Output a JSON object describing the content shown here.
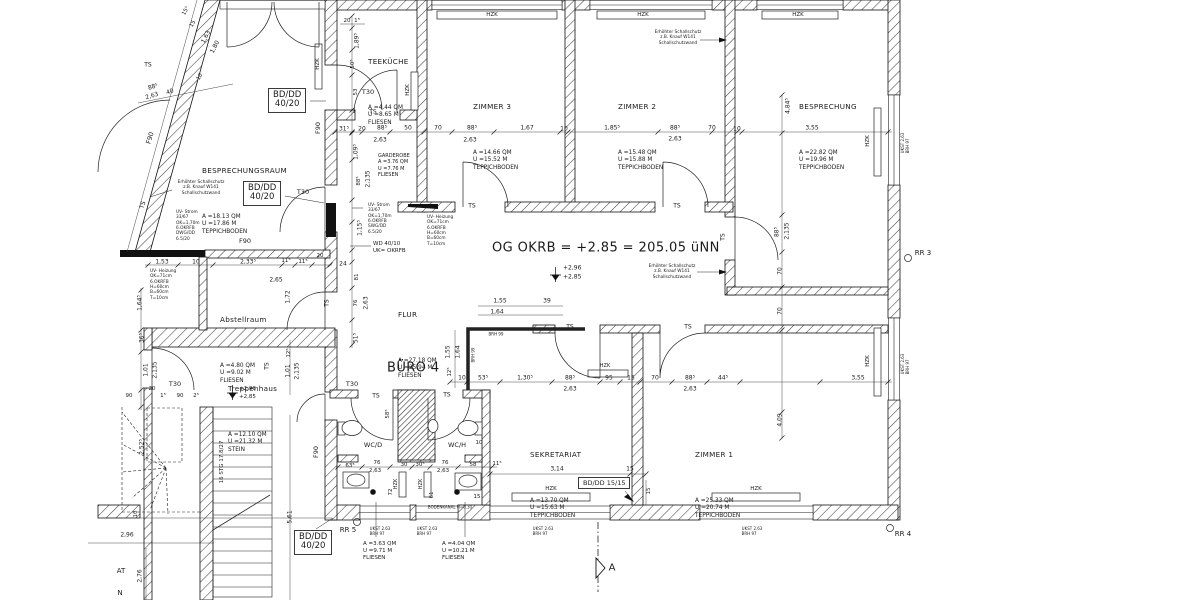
{
  "drawing": {
    "main_note": "OG OKRB = +2.85 = 205.05 üNN",
    "buero_label": "BÜRO 4"
  },
  "rooms": [
    {
      "name": "TEEKÜCHE",
      "attrs": "A =4.44 QM\nU =8.65 M\nFLIESEN",
      "x": 368,
      "y": 19
    },
    {
      "name": "ZIMMER 3",
      "attrs": "A =14.66 QM\nU =15.52 M\nTEPPICHBODEN",
      "x": 473,
      "y": 64
    },
    {
      "name": "ZIMMER 2",
      "attrs": "A =15.48 QM\nU =15.88 M\nTEPPICHBODEN",
      "x": 618,
      "y": 64
    },
    {
      "name": "BESPRECHUNG",
      "attrs": "A =22.82 QM\nU =19.96 M\nTEPPICHBODEN",
      "x": 799,
      "y": 64
    },
    {
      "name": "BESPRECHUNGSRAUM",
      "attrs": "A =18.13 QM\nU =17.86 M\nTEPPICHBODEN",
      "x": 202,
      "y": 128
    },
    {
      "name": "Abstellraum",
      "attrs": "A =4.80 QM\nU =9.02 M\nFLIESEN",
      "x": 220,
      "y": 277
    },
    {
      "name": "FLUR",
      "attrs": "A =27.18 QM\nU =25.94 M\nFLIESEN",
      "x": 398,
      "y": 272
    },
    {
      "name": "Treppenhaus",
      "attrs": "A =12.10 QM\nU =21.32 M\nSTEIN",
      "x": 228,
      "y": 346
    },
    {
      "name": "SEKRETARIAT",
      "attrs": "A =13.70 QM\nU =15.63 M\nTEPPICHBODEN",
      "x": 530,
      "y": 412
    },
    {
      "name": "ZIMMER 1",
      "attrs": "A =25.33 QM\nU =20.74 M\nTEPPICHBODEN",
      "x": 695,
      "y": 412
    }
  ],
  "big_texts": [
    {
      "t": "OG OKRB = +2.85 = 205.05 üNN",
      "x": 492,
      "y": 248,
      "fs": 13,
      "a": "l"
    },
    {
      "t": "BÜRO 4",
      "x": 387,
      "y": 368,
      "fs": 13,
      "a": "l"
    }
  ],
  "boxes": [
    {
      "t": "BD/DD\n40/20",
      "x": 268,
      "y": 88
    },
    {
      "t": "BD/DD\n40/20",
      "x": 243,
      "y": 181
    },
    {
      "t": "BD/DD\n40/20",
      "x": 294,
      "y": 530
    },
    {
      "t": "BD/DD 15/15",
      "x": 578,
      "y": 477,
      "fs": 6.5
    }
  ],
  "labels": [
    {
      "t": "T30",
      "x": 368,
      "y": 92,
      "fs": 6.5
    },
    {
      "t": "T30",
      "x": 303,
      "y": 192,
      "fs": 6.5
    },
    {
      "t": "T30",
      "x": 175,
      "y": 384,
      "fs": 6.5
    },
    {
      "t": "T30",
      "x": 352,
      "y": 384,
      "fs": 6.5
    },
    {
      "t": "TS",
      "x": 148,
      "y": 65,
      "fs": 6
    },
    {
      "t": "TS",
      "x": 373,
      "y": 112,
      "fs": 6
    },
    {
      "t": "TS",
      "x": 472,
      "y": 206,
      "fs": 6
    },
    {
      "t": "TS",
      "x": 677,
      "y": 206,
      "fs": 6
    },
    {
      "t": "TS",
      "x": 723,
      "y": 237,
      "r": -90,
      "fs": 6
    },
    {
      "t": "TS",
      "x": 570,
      "y": 327,
      "fs": 6
    },
    {
      "t": "TS",
      "x": 688,
      "y": 327,
      "fs": 6
    },
    {
      "t": "TS",
      "x": 376,
      "y": 396,
      "fs": 6
    },
    {
      "t": "TS",
      "x": 447,
      "y": 395,
      "fs": 6
    },
    {
      "t": "TS",
      "x": 267,
      "y": 366,
      "r": -90,
      "fs": 6
    },
    {
      "t": "TS",
      "x": 327,
      "y": 303,
      "r": -90,
      "fs": 6
    },
    {
      "t": "TS",
      "x": 143,
      "y": 205,
      "r": -72,
      "fs": 6
    },
    {
      "t": "F90",
      "x": 150,
      "y": 138,
      "r": -73,
      "fs": 6.5
    },
    {
      "t": "F90",
      "x": 318,
      "y": 128,
      "r": -90,
      "fs": 6.5
    },
    {
      "t": "F90",
      "x": 245,
      "y": 241,
      "fs": 6.5
    },
    {
      "t": "F90",
      "x": 316,
      "y": 452,
      "r": -90,
      "fs": 6.5
    },
    {
      "t": "HZK",
      "x": 492,
      "y": 15,
      "fs": 5.5
    },
    {
      "t": "HZK",
      "x": 643,
      "y": 15,
      "fs": 5.5
    },
    {
      "t": "HZK",
      "x": 798,
      "y": 15,
      "fs": 5.5
    },
    {
      "t": "HZK",
      "x": 551,
      "y": 489,
      "fs": 5.5
    },
    {
      "t": "HZK",
      "x": 756,
      "y": 489,
      "fs": 5.5
    },
    {
      "t": "HZK",
      "x": 605,
      "y": 366,
      "fs": 5
    },
    {
      "t": "HZK",
      "x": 408,
      "y": 90,
      "r": -90,
      "fs": 5.5
    },
    {
      "t": "HZK",
      "x": 318,
      "y": 64,
      "r": -90,
      "fs": 5.5
    },
    {
      "t": "HZK",
      "x": 868,
      "y": 141,
      "r": -90,
      "fs": 5.5
    },
    {
      "t": "HZK",
      "x": 868,
      "y": 361,
      "r": -90,
      "fs": 5.5
    },
    {
      "t": "HZK",
      "x": 396,
      "y": 484,
      "r": -90,
      "fs": 5
    },
    {
      "t": "HZK",
      "x": 421,
      "y": 484,
      "r": -90,
      "fs": 5
    },
    {
      "t": "RR 3",
      "x": 923,
      "y": 253,
      "fs": 7
    },
    {
      "t": "RR 4",
      "x": 903,
      "y": 534,
      "fs": 7
    },
    {
      "t": "RR 5",
      "x": 348,
      "y": 530,
      "fs": 7
    },
    {
      "t": "WC/D",
      "x": 373,
      "y": 445,
      "fs": 6.5
    },
    {
      "t": "WC/H",
      "x": 457,
      "y": 445,
      "fs": 6.5
    },
    {
      "t": "+2,96",
      "x": 563,
      "y": 268,
      "fs": 6,
      "a": "l"
    },
    {
      "t": "+2,85",
      "x": 563,
      "y": 277,
      "fs": 6,
      "a": "l"
    },
    {
      "t": "+2,96",
      "x": 239,
      "y": 389,
      "fs": 5.5,
      "a": "l"
    },
    {
      "t": "+2,85",
      "x": 239,
      "y": 397,
      "fs": 5.5,
      "a": "l"
    },
    {
      "t": "BRH 99",
      "x": 496,
      "y": 334,
      "fs": 4
    },
    {
      "t": "BRH 99",
      "x": 473,
      "y": 355,
      "r": -90,
      "fs": 4
    },
    {
      "t": "UKST 2.63\nBRH 97",
      "x": 380,
      "y": 531,
      "fs": 4
    },
    {
      "t": "UKST 2.63\nBRH 97",
      "x": 427,
      "y": 531,
      "fs": 4
    },
    {
      "t": "UKST 2.63\nBRH 97",
      "x": 543,
      "y": 531,
      "fs": 4
    },
    {
      "t": "UKST 2.63\nBRH 97",
      "x": 752,
      "y": 531,
      "fs": 4
    },
    {
      "t": "UKST 2.63\nBRH 97",
      "x": 905,
      "y": 143,
      "r": -90,
      "fs": 4
    },
    {
      "t": "UKST 2.63\nBRH 97",
      "x": 905,
      "y": 364,
      "r": -90,
      "fs": 4
    },
    {
      "t": "16 STG 17.8/27",
      "x": 222,
      "y": 462,
      "r": -90,
      "fs": 5.5
    },
    {
      "t": "BODENKANAL H=0.30",
      "x": 450,
      "y": 507,
      "fs": 4
    },
    {
      "t": "AT",
      "x": 121,
      "y": 571,
      "fs": 7
    },
    {
      "t": "N",
      "x": 120,
      "y": 593,
      "fs": 7
    },
    {
      "t": "A",
      "x": 612,
      "y": 568,
      "fs": 10
    }
  ],
  "dims": [
    {
      "t": "31⁵",
      "x": 344,
      "y": 129
    },
    {
      "t": "20",
      "x": 362,
      "y": 129
    },
    {
      "t": "88⁵",
      "x": 382,
      "y": 128
    },
    {
      "t": "2,63",
      "x": 380,
      "y": 140
    },
    {
      "t": "50",
      "x": 408,
      "y": 128
    },
    {
      "t": "70",
      "x": 438,
      "y": 128
    },
    {
      "t": "88⁵",
      "x": 472,
      "y": 128
    },
    {
      "t": "2,63",
      "x": 470,
      "y": 140
    },
    {
      "t": "1,67",
      "x": 527,
      "y": 128
    },
    {
      "t": "10",
      "x": 564,
      "y": 129
    },
    {
      "t": "1,85⁵",
      "x": 612,
      "y": 128
    },
    {
      "t": "88⁵",
      "x": 675,
      "y": 128
    },
    {
      "t": "2,63",
      "x": 675,
      "y": 139
    },
    {
      "t": "70",
      "x": 712,
      "y": 128
    },
    {
      "t": "10",
      "x": 737,
      "y": 129
    },
    {
      "t": "3,55",
      "x": 812,
      "y": 128
    },
    {
      "t": "4,84⁵",
      "x": 788,
      "y": 106,
      "r": -90
    },
    {
      "t": "88⁵",
      "x": 777,
      "y": 232,
      "r": -90
    },
    {
      "t": "2,135",
      "x": 787,
      "y": 231,
      "r": -90
    },
    {
      "t": "70",
      "x": 780,
      "y": 271,
      "r": -90
    },
    {
      "t": "70",
      "x": 780,
      "y": 311,
      "r": -90
    },
    {
      "t": "4,09",
      "x": 780,
      "y": 420,
      "r": -90
    },
    {
      "t": "3,55",
      "x": 858,
      "y": 378
    },
    {
      "t": "44⁵",
      "x": 723,
      "y": 378
    },
    {
      "t": "88⁵",
      "x": 690,
      "y": 378
    },
    {
      "t": "2,63",
      "x": 690,
      "y": 389
    },
    {
      "t": "70",
      "x": 655,
      "y": 378
    },
    {
      "t": "15",
      "x": 631,
      "y": 378
    },
    {
      "t": "95",
      "x": 609,
      "y": 378
    },
    {
      "t": "88⁵",
      "x": 570,
      "y": 378
    },
    {
      "t": "2,63",
      "x": 570,
      "y": 389
    },
    {
      "t": "1,30⁵",
      "x": 525,
      "y": 378
    },
    {
      "t": "53⁵",
      "x": 483,
      "y": 378
    },
    {
      "t": "10",
      "x": 462,
      "y": 378
    },
    {
      "t": "12⁵",
      "x": 450,
      "y": 372,
      "r": -90,
      "fs": 5.5
    },
    {
      "t": "1,55",
      "x": 500,
      "y": 301
    },
    {
      "t": "39",
      "x": 547,
      "y": 301
    },
    {
      "t": "1,64",
      "x": 497,
      "y": 312
    },
    {
      "t": "1,55",
      "x": 448,
      "y": 352,
      "r": -90
    },
    {
      "t": "1,64",
      "x": 458,
      "y": 352,
      "r": -90
    },
    {
      "t": "3,14",
      "x": 557,
      "y": 469
    },
    {
      "t": "15",
      "x": 630,
      "y": 469
    },
    {
      "t": "15",
      "x": 649,
      "y": 491,
      "r": -90,
      "fs": 5.5
    },
    {
      "t": "11⁵",
      "x": 497,
      "y": 464,
      "fs": 5.5
    },
    {
      "t": "63⁵",
      "x": 350,
      "y": 466,
      "fs": 5.5
    },
    {
      "t": "76",
      "x": 377,
      "y": 463,
      "fs": 5.5
    },
    {
      "t": "2,63",
      "x": 375,
      "y": 471,
      "fs": 5.5
    },
    {
      "t": "30",
      "x": 404,
      "y": 465,
      "fs": 5.5
    },
    {
      "t": "30⁵",
      "x": 420,
      "y": 465,
      "fs": 5.5
    },
    {
      "t": "76",
      "x": 445,
      "y": 463,
      "fs": 5.5
    },
    {
      "t": "2,63",
      "x": 443,
      "y": 471,
      "fs": 5.5
    },
    {
      "t": "58",
      "x": 473,
      "y": 465,
      "fs": 5.5
    },
    {
      "t": "72",
      "x": 391,
      "y": 492,
      "r": -90,
      "fs": 5.5
    },
    {
      "t": "61",
      "x": 432,
      "y": 495,
      "r": -90,
      "fs": 5.5
    },
    {
      "t": "15",
      "x": 477,
      "y": 497,
      "fs": 5.5
    },
    {
      "t": "58⁵",
      "x": 388,
      "y": 414,
      "r": -90,
      "fs": 5.5
    },
    {
      "t": "10",
      "x": 479,
      "y": 443,
      "fs": 5.5
    },
    {
      "t": "1,53",
      "x": 162,
      "y": 262
    },
    {
      "t": "10",
      "x": 196,
      "y": 262
    },
    {
      "t": "2,33⁵",
      "x": 248,
      "y": 262
    },
    {
      "t": "11⁵",
      "x": 286,
      "y": 261,
      "fs": 5.5
    },
    {
      "t": "11⁵",
      "x": 303,
      "y": 262,
      "fs": 5.5
    },
    {
      "t": "20",
      "x": 320,
      "y": 256,
      "fs": 5.5
    },
    {
      "t": "2,65",
      "x": 276,
      "y": 280
    },
    {
      "t": "1,72",
      "x": 288,
      "y": 297,
      "r": -90
    },
    {
      "t": "1,64⁵",
      "x": 140,
      "y": 303,
      "r": -90
    },
    {
      "t": "36⁵",
      "x": 142,
      "y": 338,
      "r": -90
    },
    {
      "t": "1,01",
      "x": 146,
      "y": 370,
      "r": -90
    },
    {
      "t": "2,135",
      "x": 155,
      "y": 370,
      "r": -90
    },
    {
      "t": "12⁵",
      "x": 289,
      "y": 353,
      "r": -90,
      "fs": 5.5
    },
    {
      "t": "1,01",
      "x": 288,
      "y": 371,
      "r": -90
    },
    {
      "t": "2,135",
      "x": 297,
      "y": 371,
      "r": -90
    },
    {
      "t": "90",
      "x": 129,
      "y": 396,
      "fs": 5.5
    },
    {
      "t": "1⁵",
      "x": 163,
      "y": 396,
      "fs": 5.5
    },
    {
      "t": "90",
      "x": 180,
      "y": 396,
      "fs": 5.5
    },
    {
      "t": "2⁵",
      "x": 196,
      "y": 396,
      "fs": 5.5
    },
    {
      "t": "20",
      "x": 152,
      "y": 389,
      "fs": 5.5
    },
    {
      "t": "2,96",
      "x": 127,
      "y": 535
    },
    {
      "t": "10",
      "x": 136,
      "y": 514,
      "r": -90,
      "fs": 5.5
    },
    {
      "t": "2,76",
      "x": 140,
      "y": 576,
      "r": -90
    },
    {
      "t": "2,52⁵",
      "x": 142,
      "y": 447,
      "r": -90
    },
    {
      "t": "5,61",
      "x": 290,
      "y": 517,
      "r": -90
    },
    {
      "t": "20",
      "x": 347,
      "y": 21,
      "fs": 5.5
    },
    {
      "t": "1⁵",
      "x": 357,
      "y": 21,
      "fs": 5.5
    },
    {
      "t": "1,89⁵",
      "x": 357,
      "y": 41,
      "r": -90
    },
    {
      "t": "50⁵",
      "x": 353,
      "y": 64,
      "r": -90,
      "fs": 5.5
    },
    {
      "t": "53",
      "x": 356,
      "y": 92,
      "r": -90,
      "fs": 5.5
    },
    {
      "t": "1,09⁵",
      "x": 356,
      "y": 152,
      "r": -90
    },
    {
      "t": "88⁵",
      "x": 359,
      "y": 181,
      "r": -90,
      "fs": 5.5
    },
    {
      "t": "2,135",
      "x": 368,
      "y": 179,
      "r": -90
    },
    {
      "t": "1,15⁵",
      "x": 360,
      "y": 228,
      "r": -90
    },
    {
      "t": "24",
      "x": 343,
      "y": 264
    },
    {
      "t": "81",
      "x": 357,
      "y": 277,
      "r": -90,
      "fs": 5.5
    },
    {
      "t": "76",
      "x": 356,
      "y": 303,
      "r": -90,
      "fs": 5.5
    },
    {
      "t": "2,63",
      "x": 366,
      "y": 303,
      "r": -90
    },
    {
      "t": "51⁵",
      "x": 356,
      "y": 338,
      "r": -90
    },
    {
      "t": "15⁵",
      "x": 186,
      "y": 11,
      "r": -62,
      "fs": 5.5
    },
    {
      "t": "15",
      "x": 193,
      "y": 24,
      "r": -62,
      "fs": 5.5
    },
    {
      "t": "1,63",
      "x": 206,
      "y": 37,
      "r": -62
    },
    {
      "t": "1,80",
      "x": 215,
      "y": 47,
      "r": -62
    },
    {
      "t": "10",
      "x": 200,
      "y": 77,
      "r": -62,
      "fs": 5.5
    },
    {
      "t": "88⁵",
      "x": 153,
      "y": 87,
      "r": -17
    },
    {
      "t": "2,63",
      "x": 152,
      "y": 96,
      "r": -17
    },
    {
      "t": "40",
      "x": 170,
      "y": 92,
      "r": -17
    }
  ],
  "notes": [
    {
      "t": "Erhöhter Schallschutz\nz.B. Knauf W141\nSchallschutzwand",
      "x": 678,
      "y": 30,
      "a": "c"
    },
    {
      "t": "Erhöhter Schallschutz\nz.B. Knauf W141\nSchallschutzwand",
      "x": 672,
      "y": 264,
      "a": "c"
    },
    {
      "t": "Erhöhter Schallschutz\nz.B. Knauf W141\nSchallschutzwand",
      "x": 201,
      "y": 180,
      "a": "c"
    },
    {
      "t": "UV- Strom\n33/67\nOK=1,70m\n6.OKRFB\nDWG/DD\n6.5/20",
      "x": 176,
      "y": 210
    },
    {
      "t": "UV- Strom\n33/67\nOK=1,70m\n6.OKRFB\nSWG/DD\n6.5/20",
      "x": 368,
      "y": 203
    },
    {
      "t": "UV- Heizung\nOK=71cm\n6.OKRFB\nH=60cm\nB=60cm\nT=10cm",
      "x": 150,
      "y": 269
    },
    {
      "t": "UV- Heizung\nOK=71cm\n6.OKRFB\nH=60cm\nB=60cm\nT=10cm",
      "x": 427,
      "y": 215
    },
    {
      "t": "WD 40/10\nUK= OKRFB",
      "x": 373,
      "y": 241,
      "fs": 5.5
    },
    {
      "t": "GARDEROBE\nA =3.76 QM\nU =7.76 M\nFLIESEN",
      "x": 378,
      "y": 153,
      "fs": 5
    },
    {
      "t": "A =3.63 QM\nU =9.71 M\nFLIESEN",
      "x": 363,
      "y": 541,
      "fs": 5.5
    },
    {
      "t": "A =4.04 QM\nU =10.21 M\nFLIESEN",
      "x": 442,
      "y": 541,
      "fs": 5.5
    }
  ]
}
